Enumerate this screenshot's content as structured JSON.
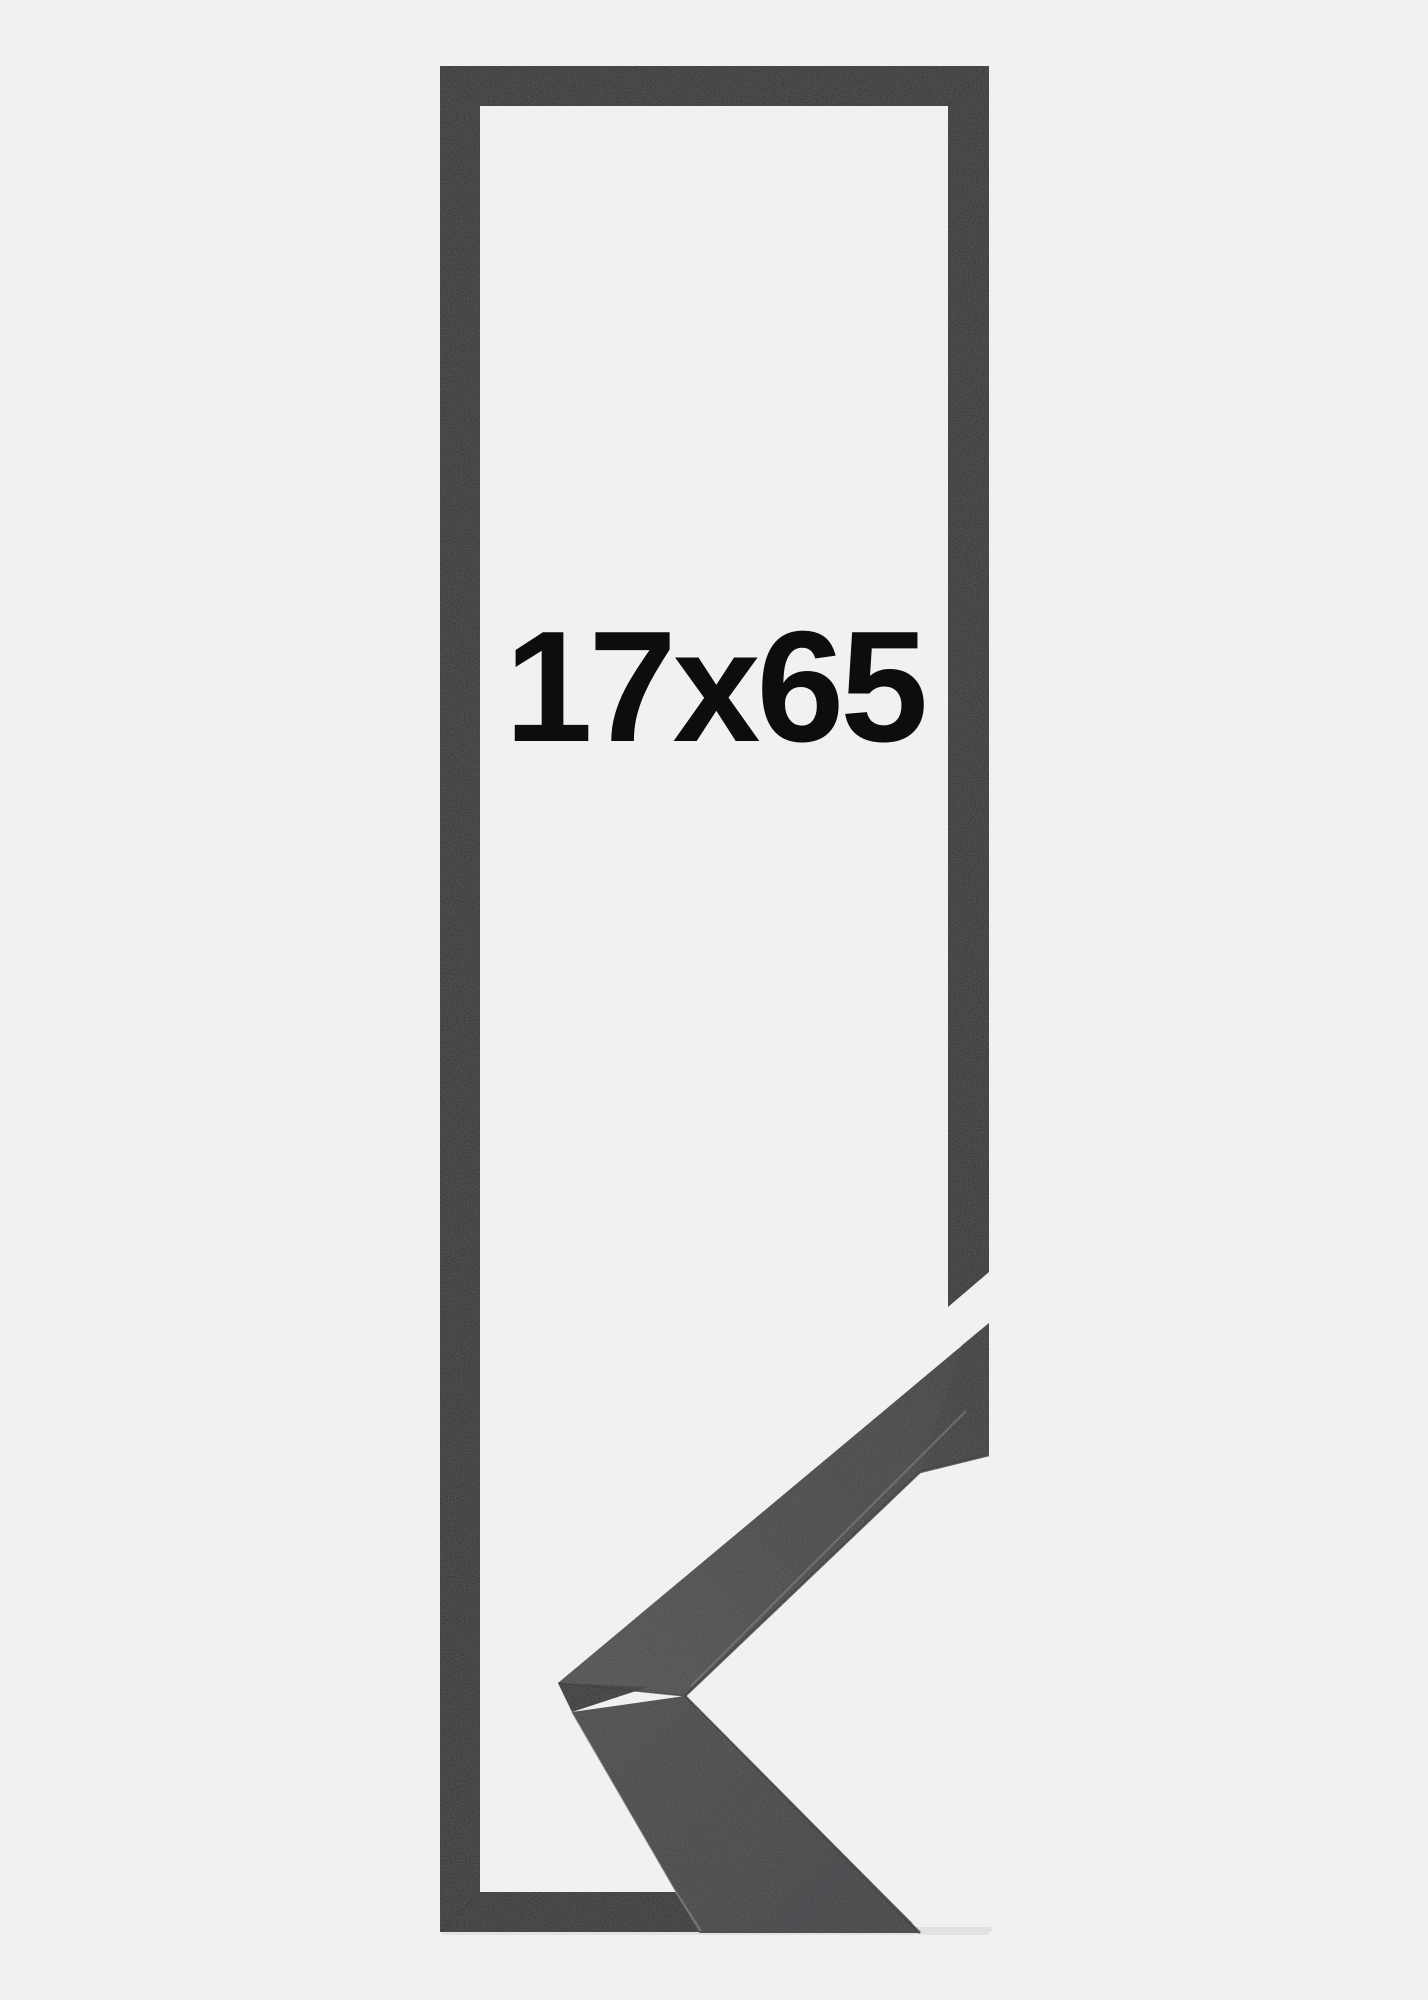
{
  "size_label": "17x65",
  "colors": {
    "background": "#F1F1F2",
    "frame_outline": "#2A2A2C",
    "sample_surface_upper_near": "#4A4A4C",
    "sample_surface_upper_far": "#38383A",
    "sample_surface_lower_near": "#434345",
    "sample_surface_lower_far": "#37373A",
    "sample_end_face": "#2D2D30",
    "sample_edge_highlight": "#77777A",
    "sample_edge_dark": "#1E1E20",
    "label_text": "#0D0D0D",
    "surface_shadow": "#DCDCDD"
  }
}
